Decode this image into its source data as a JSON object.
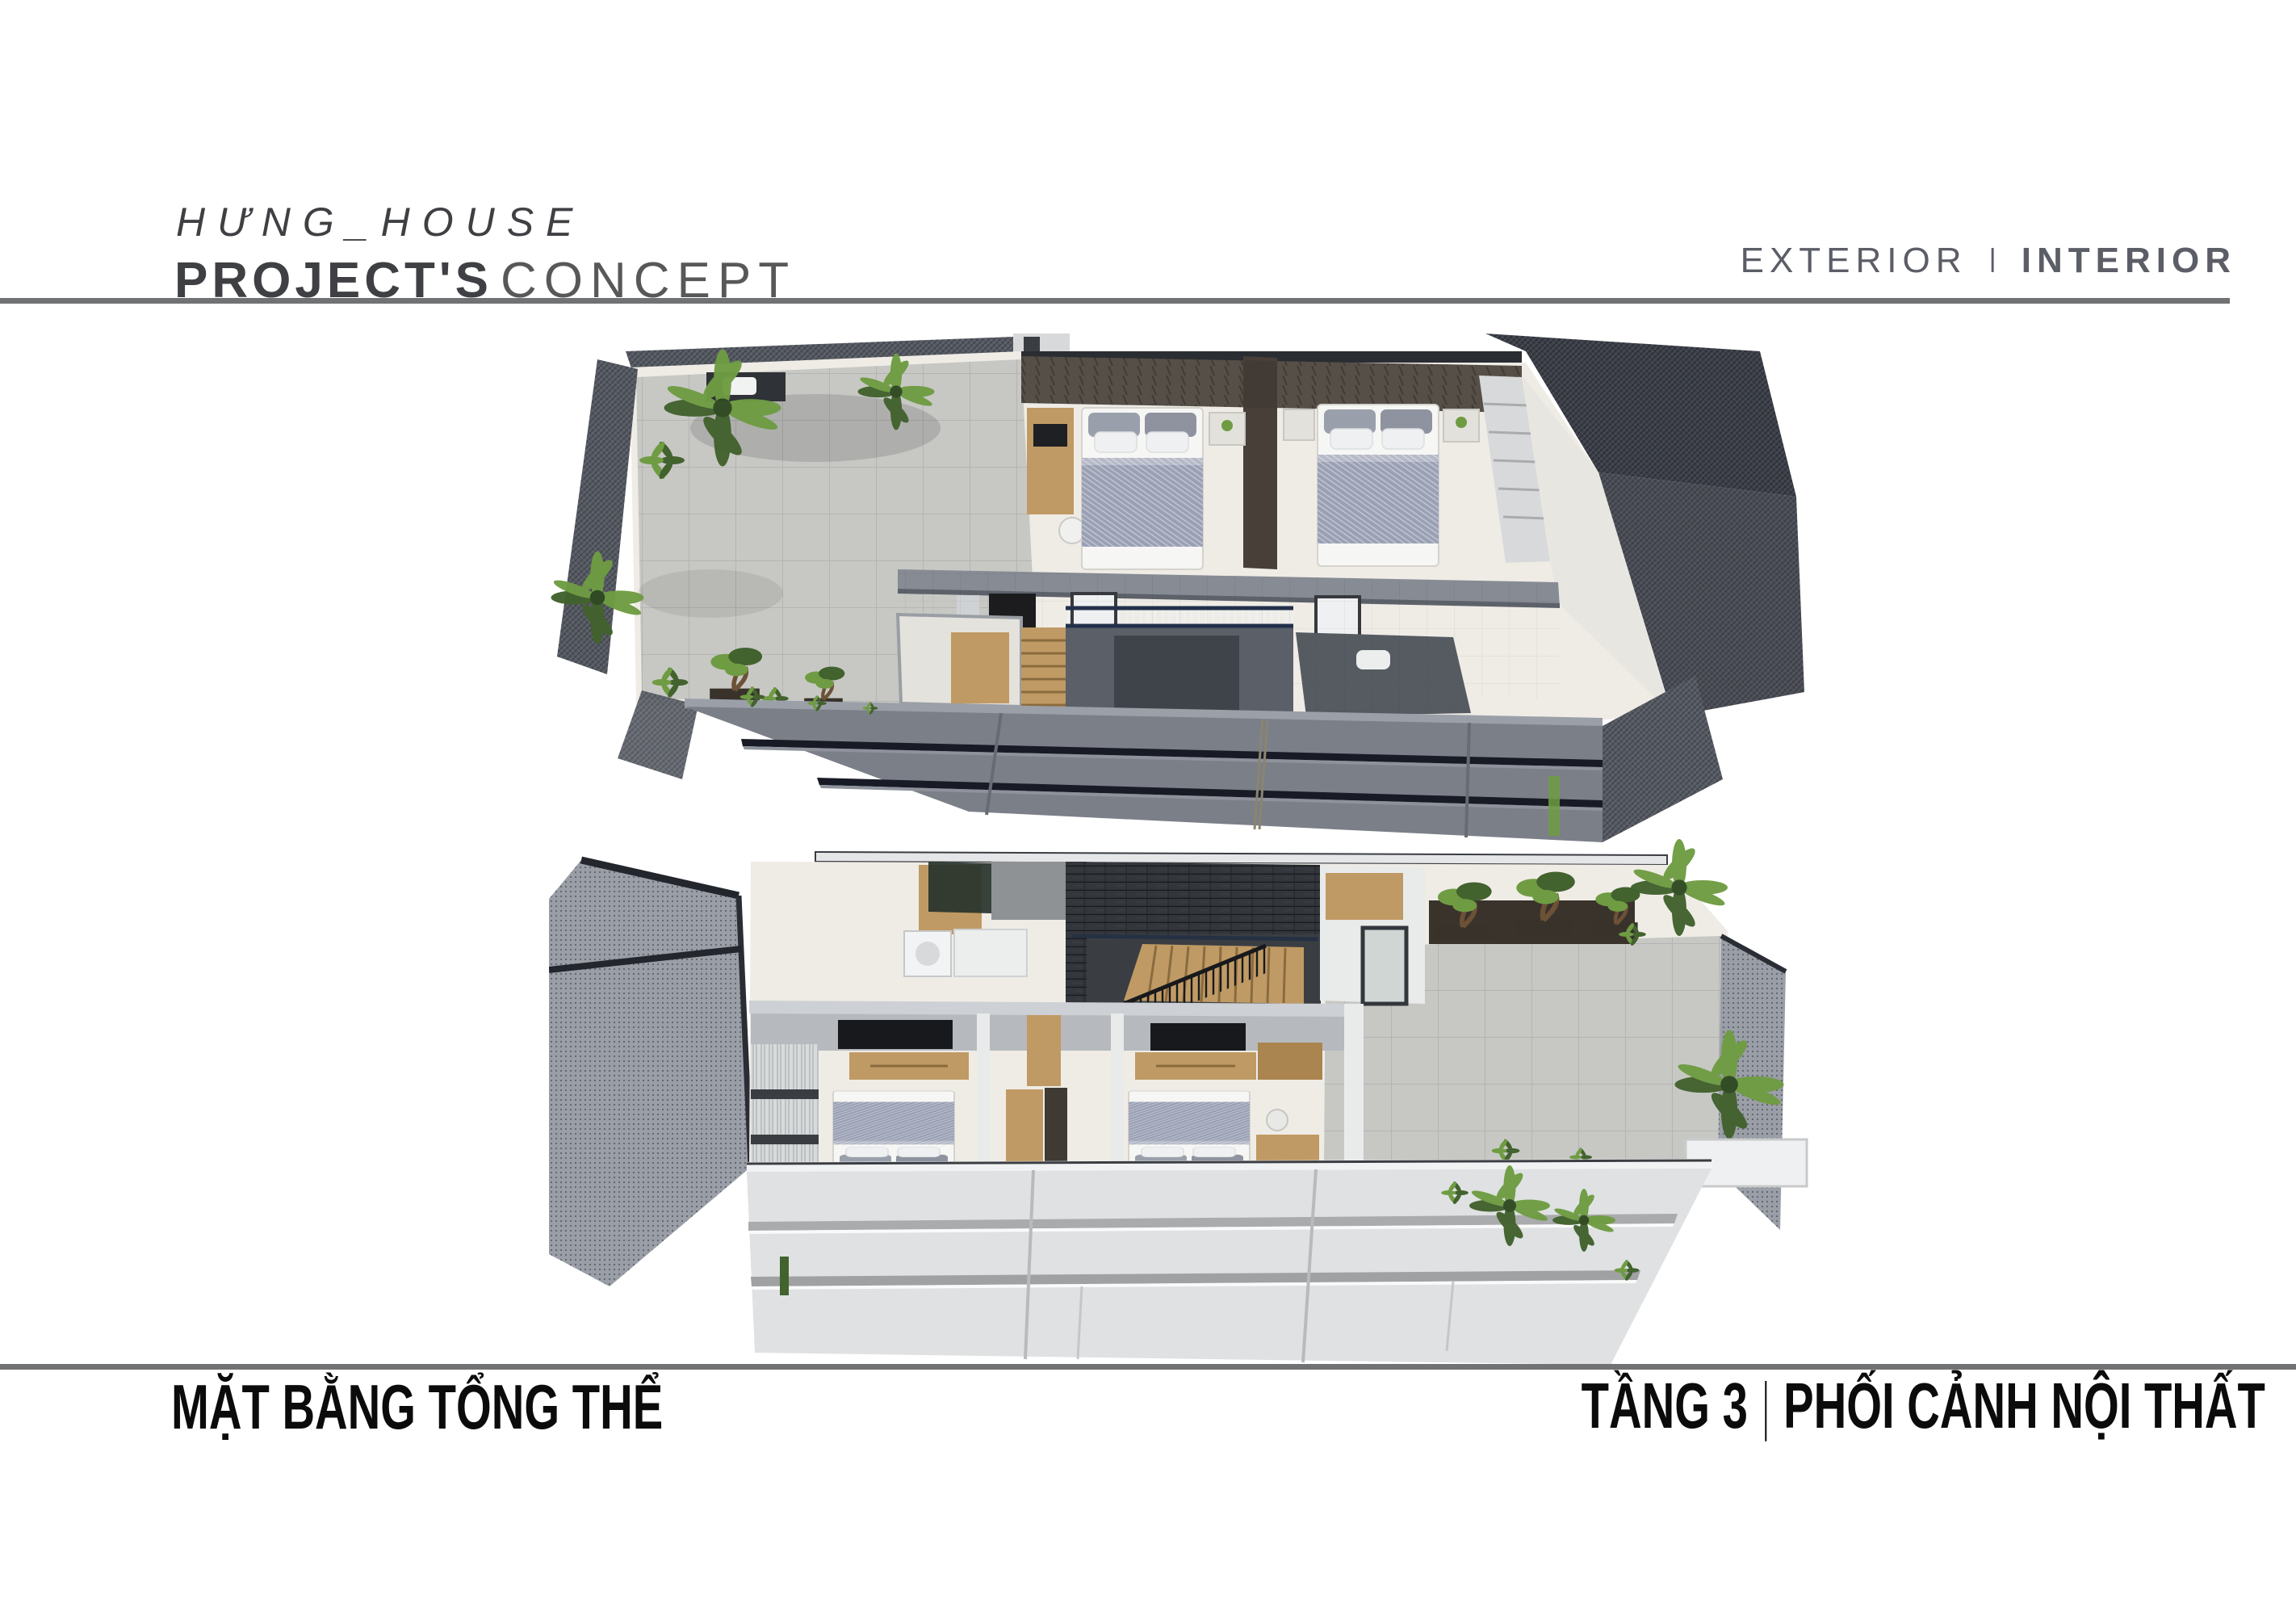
{
  "header": {
    "project_name": "HƯNG_HOUSE",
    "subtitle": {
      "bold": "PROJECT'S",
      "light": "CONCEPT"
    },
    "nav": {
      "left": "EXTERIOR",
      "separator": "I",
      "right": "INTERIOR"
    }
  },
  "footer": {
    "left_label": "MẶT BẰNG TỔNG THỂ",
    "right": {
      "floor": "TẦNG 3",
      "separator": "|",
      "label": "PHỐI CẢNH NỘI THẤT"
    }
  },
  "colors": {
    "accent_text": "#3f4043",
    "nav_text": "#5b5e66",
    "rule": "#707274",
    "footer_text": "#0b0b0b",
    "facade_dark": "#7b7f88",
    "facade_gap": "#181b26",
    "facade_light": "#dfe1e2",
    "terrace_tile": "#c7c8c4",
    "interior_floor": "#efece6",
    "wall_gray": "#878b93",
    "wall_white": "#e9eaea",
    "headboard_wood": "#5d564e",
    "stone_dark": "#33373c",
    "wood": "#c09a64",
    "bed_sheet": "#f6f6f4",
    "bed_blanket": "#9aa0b4",
    "plant_green": "#6f9c43",
    "plant_dark": "#42622e",
    "trunk_brown": "#6d5136",
    "mesh_dark": "#565a63",
    "mesh_light": "#9a9ea6",
    "railing": "#17191c"
  }
}
